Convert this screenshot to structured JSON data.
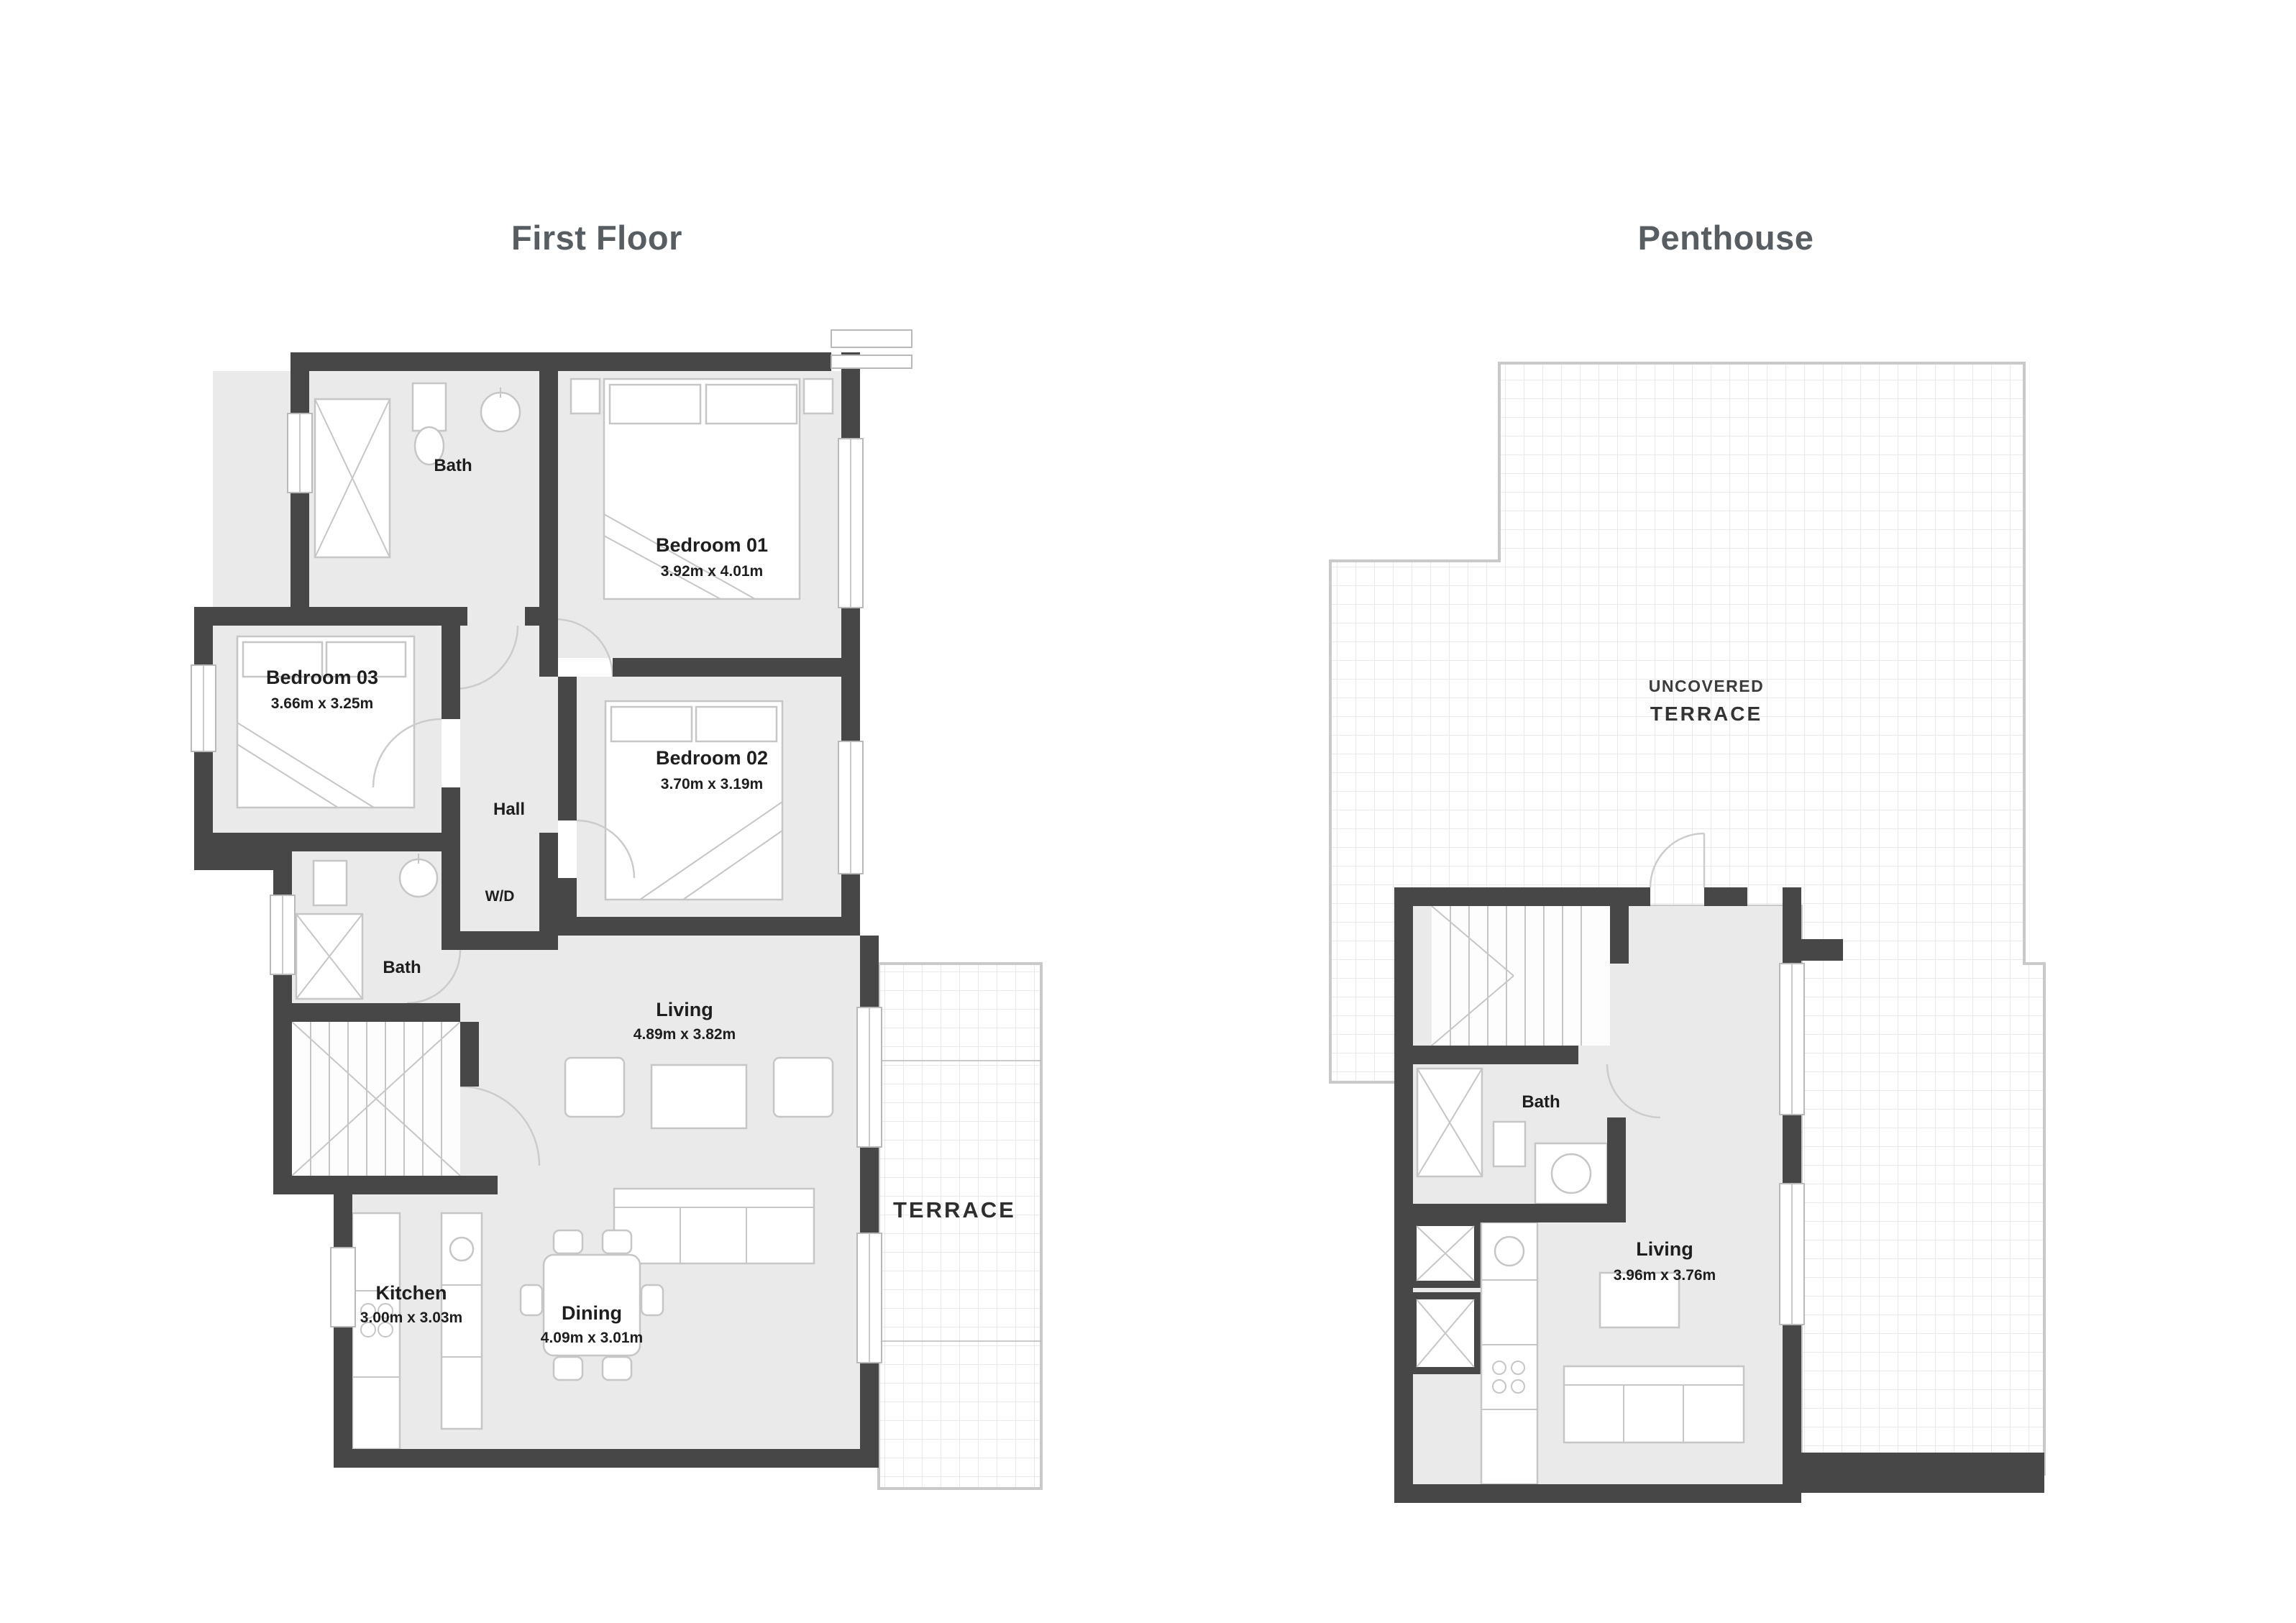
{
  "titles": {
    "first_floor": "First Floor",
    "penthouse": "Penthouse"
  },
  "first_floor": {
    "bath_top": "Bath",
    "bedroom01": {
      "name": "Bedroom 01",
      "dims": "3.92m x 4.01m"
    },
    "bedroom03": {
      "name": "Bedroom 03",
      "dims": "3.66m x 3.25m"
    },
    "bedroom02": {
      "name": "Bedroom 02",
      "dims": "3.70m x 3.19m"
    },
    "bath_mid": "Bath",
    "hall": "Hall",
    "wd": "W/D",
    "living": {
      "name": "Living",
      "dims": "4.89m x 3.82m"
    },
    "kitchen": {
      "name": "Kitchen",
      "dims": "3.00m x 3.03m"
    },
    "dining": {
      "name": "Dining",
      "dims": "4.09m x 3.01m"
    },
    "terrace": "TERRACE"
  },
  "penthouse": {
    "uncovered_terrace_line1": "UNCOVERED",
    "uncovered_terrace_line2": "TERRACE",
    "bath": "Bath",
    "living": {
      "name": "Living",
      "dims": "3.96m x 3.76m"
    }
  },
  "colors": {
    "wall": "#474747",
    "room_fill": "#eaeaea",
    "title_text": "#585d62",
    "grid_line": "#e3e3e3"
  }
}
